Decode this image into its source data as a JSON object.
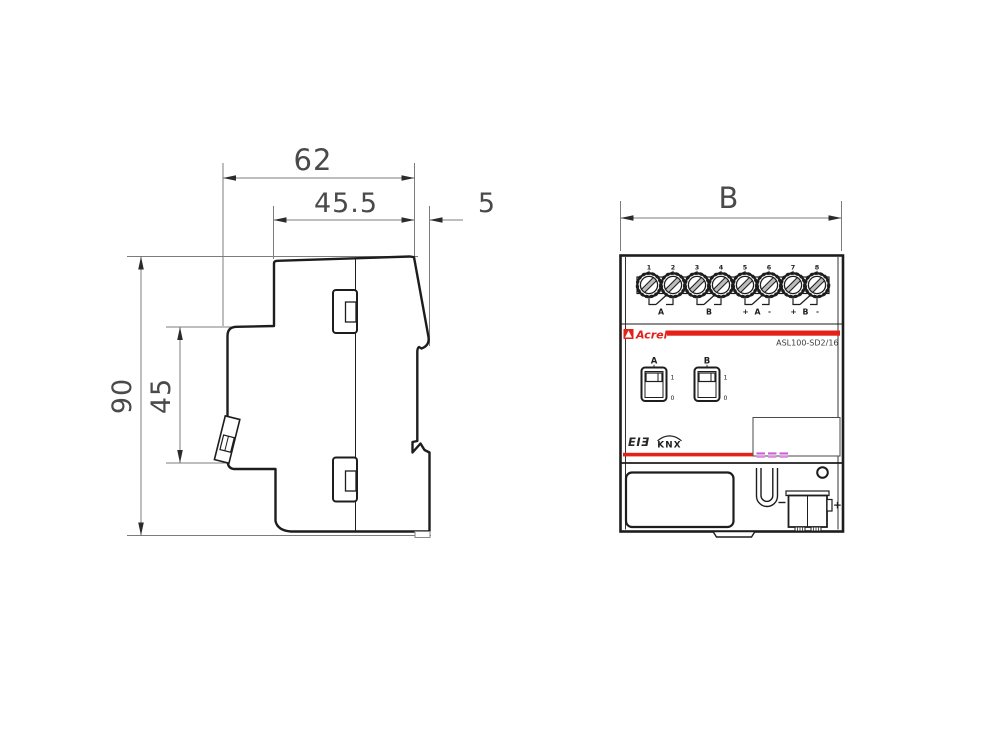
{
  "side_view": {
    "width_total": "62",
    "width_front": "45.5",
    "din_depth": "5",
    "height_total": "90",
    "height_clip": "45"
  },
  "front_view": {
    "width_label": "B",
    "terminals": {
      "numbers": [
        "1",
        "2",
        "3",
        "4",
        "5",
        "6",
        "7",
        "8"
      ],
      "groups": [
        {
          "label": "A"
        },
        {
          "label": "B"
        },
        {
          "plus": "+",
          "label": "A",
          "minus": "-"
        },
        {
          "plus": "+",
          "label": "B",
          "minus": "-"
        }
      ]
    },
    "brand": "Acrel",
    "model": "ASL100-SD2/16",
    "switches": [
      {
        "label": "A",
        "on_label": "1",
        "off_label": "0"
      },
      {
        "label": "B",
        "on_label": "1",
        "off_label": "0"
      }
    ],
    "bus_logos": {
      "eib": "EIƎ",
      "knx": "KNX"
    },
    "connector_plus": "+"
  },
  "colors": {
    "accent_red": "#e32119",
    "led_magenta": "#cf5fd6",
    "ink": "#1d1d1d",
    "dim_line": "#7c7c7c"
  }
}
